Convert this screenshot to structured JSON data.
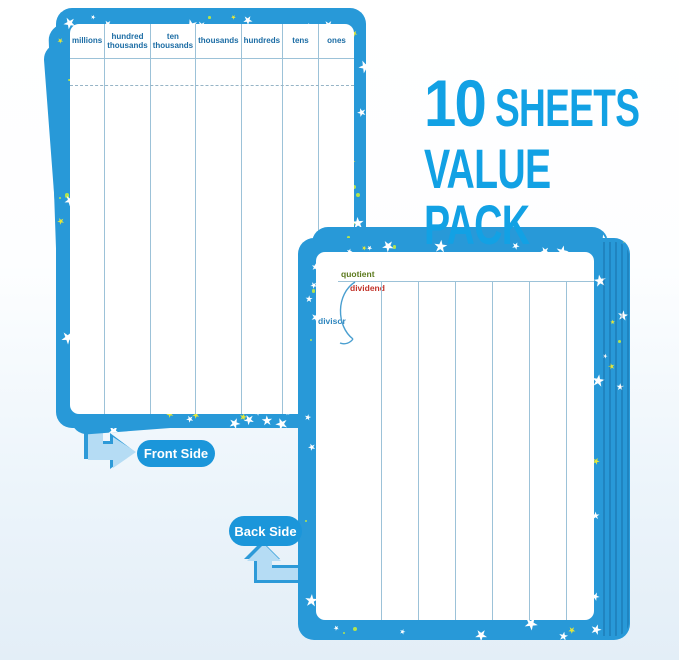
{
  "headline": {
    "count": "10",
    "sheets_word": "SHEETS",
    "value_pack": "VALUE PACK"
  },
  "front_board": {
    "side_label": "Front Side",
    "column_headers": [
      "millions",
      "hundred thousands",
      "ten thousands",
      "thousands",
      "hundreds",
      "tens",
      "ones"
    ]
  },
  "back_board": {
    "side_label": "Back Side",
    "labels": {
      "quotient": "quotient",
      "dividend": "dividend",
      "divisor": "divisor"
    }
  },
  "style": {
    "board_blue": "#2899d8",
    "grid_line": "#9cc2d8",
    "header_text": "#1b6ca4",
    "pill_blue": "#1b96da",
    "headline_color": "#12a1e4",
    "quotient_color": "#5c7a1d",
    "dividend_color": "#c2332a",
    "divisor_color": "#2f86be",
    "arrow_light": "#b5dcf4",
    "arrow_dark": "#2d9ad8",
    "star_white": "#ffffff",
    "star_yellow": "#e4e63a",
    "dot_lime": "#b4e34e"
  }
}
